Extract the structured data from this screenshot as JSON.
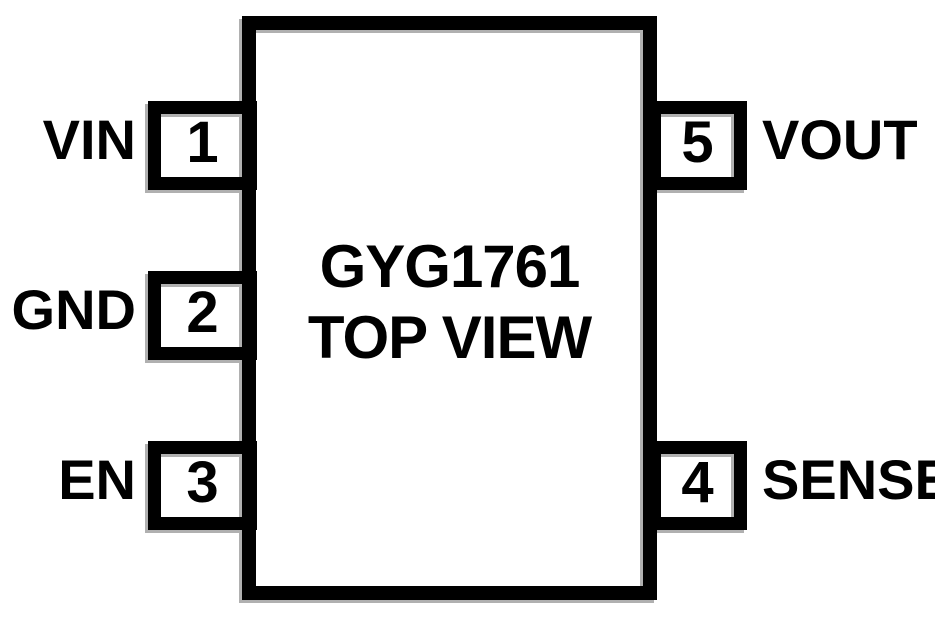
{
  "chip": {
    "name": "GYG1761",
    "view": "TOP VIEW"
  },
  "pins": {
    "left": [
      {
        "number": "1",
        "label": "VIN"
      },
      {
        "number": "2",
        "label": "GND"
      },
      {
        "number": "3",
        "label": "EN"
      }
    ],
    "right": [
      {
        "number": "5",
        "label": "VOUT"
      },
      {
        "number": "4",
        "label": "SENSE"
      }
    ]
  },
  "colors": {
    "line": "#000000",
    "shadow": "#b0b0b0",
    "text": "#000000",
    "background": "#ffffff"
  }
}
